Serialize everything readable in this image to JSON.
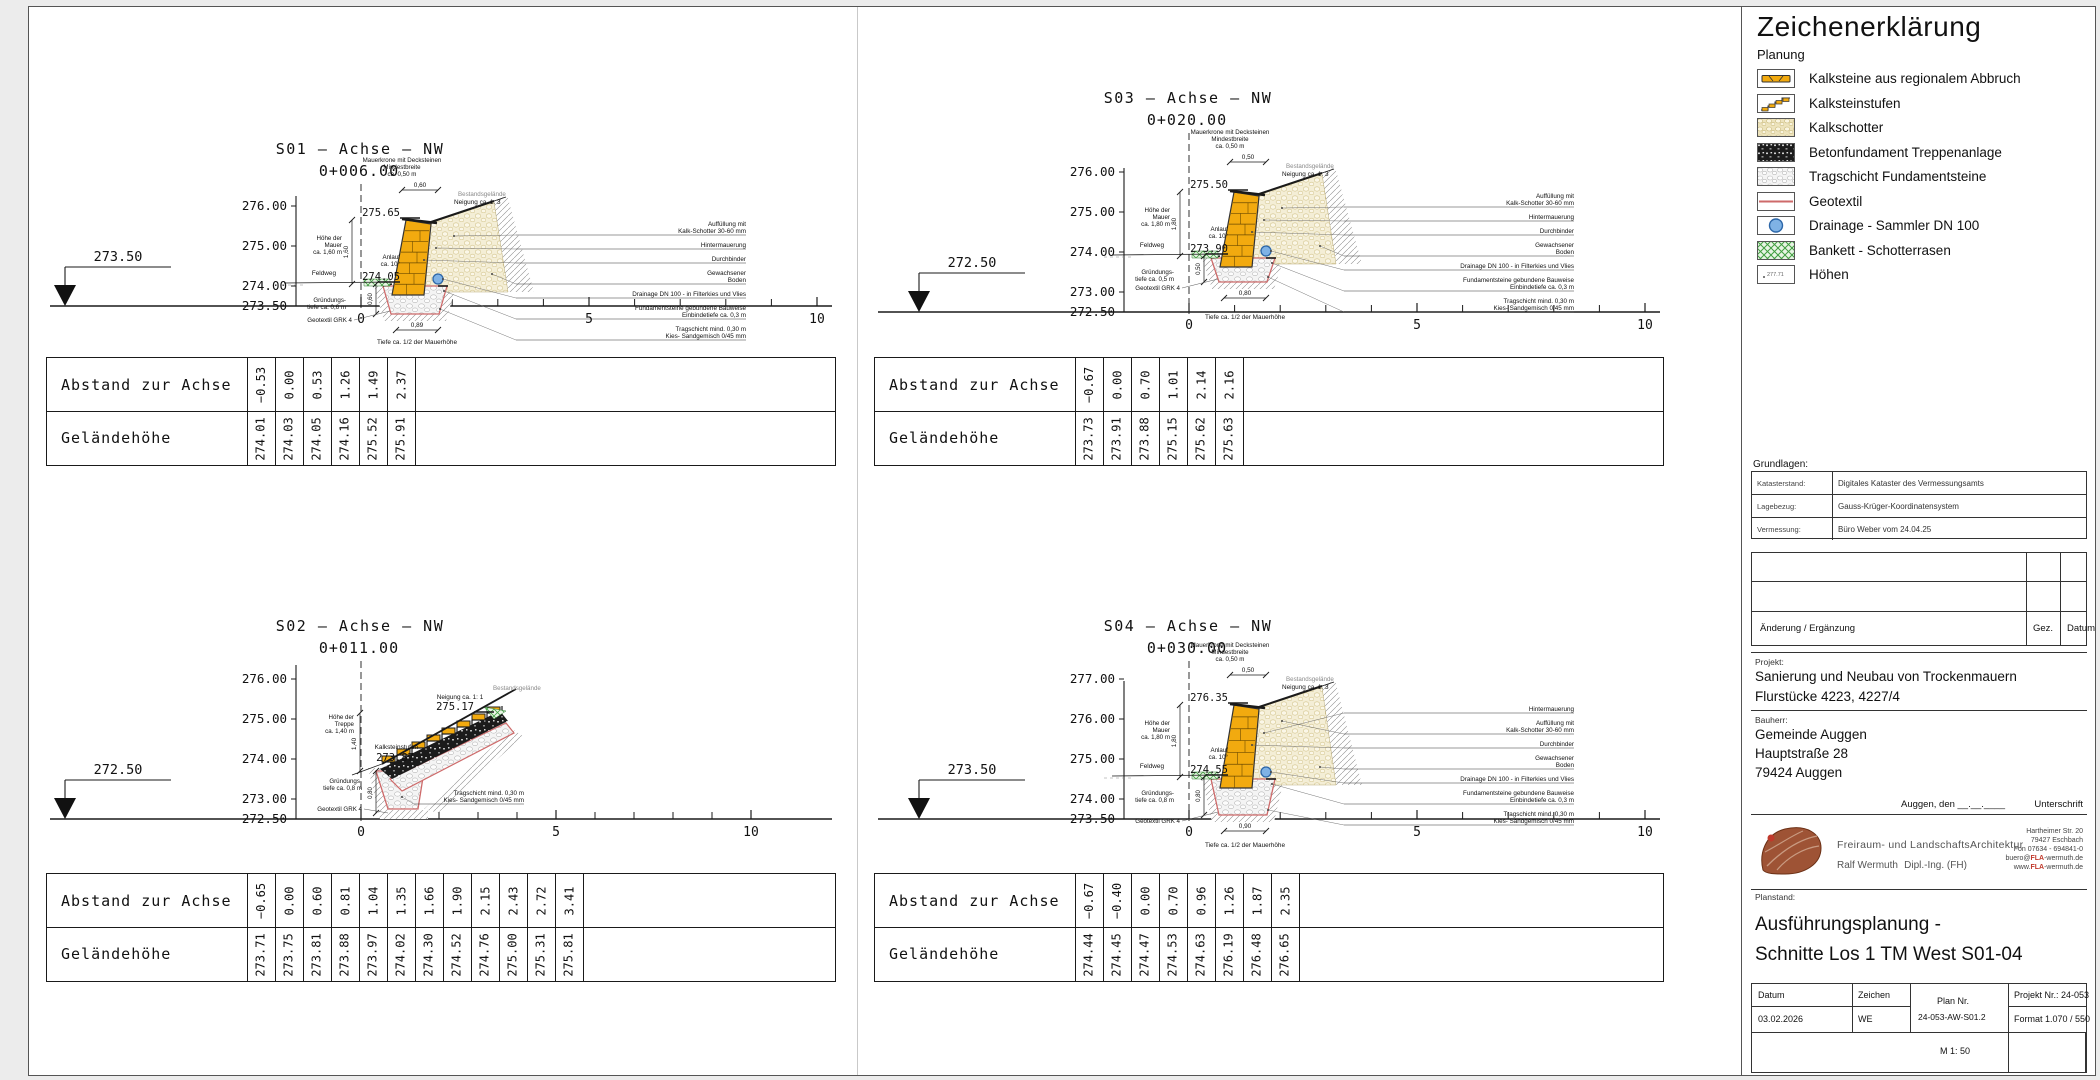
{
  "colors": {
    "stone": "#F2AA0F",
    "stone_edge": "#333333",
    "backfill_bg": "#F4EED6",
    "backfill_dot": "#D3C48C",
    "tragschicht_bg": "#F4F4F4",
    "tragschicht_dot": "#B8B8B8",
    "hatch": "#8F8F8F",
    "geotextil": "#CE6A6A",
    "drainage_fill": "#7FB2E5",
    "drainage_edge": "#2C66A8",
    "green": "#44A244",
    "beton": "#1B1B1B"
  },
  "table_labels": {
    "abstand": "Abstand zur Achse",
    "gelaende": "Geländehöhe"
  },
  "sections": [
    {
      "id": "S01",
      "title": "S01  –  Achse  –  NW",
      "station": "0+006.00",
      "type": "wall",
      "ref_height": "273.50",
      "datum_elev": 273.5,
      "y_ticks": [
        "276.00",
        "275.00",
        "274.00",
        "273.50"
      ],
      "x_ticks": [
        "0",
        "5",
        "10"
      ],
      "crest_label": "275.65",
      "crest_elev": 275.65,
      "base_label": "274.05",
      "base_elev": 274.05,
      "top_note": [
        "Mauerkrone mit Decksteinen",
        "Mindestbreite",
        "ca. 0,50 m"
      ],
      "slope_note": "Neigung ca. 1: 3",
      "terrain_label": "Bestandsgelände",
      "left_notes": {
        "hoehe": [
          "Höhe der",
          "Mauer",
          "ca. 1,60 m"
        ],
        "weg": "Feldweg",
        "anlauf": [
          "Anlauf",
          "ca. 10°"
        ],
        "gruendung": [
          "Gründungs-",
          "tiefe ca. 0,6 m"
        ],
        "geotextil": "Geotextil GRK 4"
      },
      "dims": {
        "top": "0,60",
        "height": "1,60",
        "depth": "0,60",
        "bottom": "0,89"
      },
      "right_notes": [
        [
          "Auffüllung mit",
          "Kalk-Schotter 30-60 mm"
        ],
        [
          "Hintermauerung"
        ],
        [
          "Durchbinder"
        ],
        [
          "Gewachsener",
          "Boden"
        ],
        [
          "Drainage DN 100 - in Filterkies und Vlies"
        ],
        [
          "Fundamentsteine gebundene Bauweise",
          "Einbindetiefe ca. 0,3 m"
        ],
        [
          "Tragschicht mind. 0,30 m",
          "Kies- Sandgemisch 0/45 mm"
        ]
      ],
      "bottom_note": "Tiefe ca. 1/2 der Mauerhöhe",
      "table": {
        "abstand": [
          "-0.53",
          "0.00",
          "0.53",
          "1.26",
          "1.49",
          "2.37"
        ],
        "gelaende": [
          "274.01",
          "274.03",
          "274.05",
          "274.16",
          "275.52",
          "275.91"
        ]
      }
    },
    {
      "id": "S02",
      "title": "S02  –  Achse  –  NW",
      "station": "0+011.00",
      "type": "stairs",
      "ref_height": "272.50",
      "datum_elev": 272.5,
      "y_ticks": [
        "276.00",
        "275.00",
        "274.00",
        "273.00",
        "272.50"
      ],
      "x_ticks": [
        "0",
        "5",
        "10"
      ],
      "crest_label": "275.17",
      "crest_elev": 275.17,
      "base_label": "273.87",
      "base_elev": 273.87,
      "slope_note": "Neigung ca. 1: 1",
      "terrain_label": "Bestandsgelände",
      "stufen_label": "Kalksteinstufen",
      "left_notes": {
        "hoehe": [
          "Höhe der",
          "Treppe",
          "ca. 1,40 m"
        ],
        "gruendung": [
          "Gründungs-",
          "tiefe ca. 0,8 m"
        ],
        "geotextil": "Geotextil GRK 4"
      },
      "dims": {
        "height": "1,40",
        "depth": "0,80"
      },
      "right_notes": [
        [
          "Tragschicht mind. 0,30 m",
          "Kies- Sandgemisch 0/45 mm"
        ]
      ],
      "table": {
        "abstand": [
          "-0.65",
          "0.00",
          "0.60",
          "0.81",
          "1.04",
          "1.35",
          "1.66",
          "1.90",
          "2.15",
          "2.43",
          "2.72",
          "3.41"
        ],
        "gelaende": [
          "273.71",
          "273.75",
          "273.81",
          "273.88",
          "273.97",
          "274.02",
          "274.30",
          "274.52",
          "274.76",
          "275.00",
          "275.31",
          "275.81"
        ]
      }
    },
    {
      "id": "S03",
      "title": "S03  –  Achse  –  NW",
      "station": "0+020.00",
      "type": "wall",
      "ref_height": "272.50",
      "datum_elev": 272.5,
      "y_ticks": [
        "276.00",
        "275.00",
        "274.00",
        "273.00",
        "272.50"
      ],
      "x_ticks": [
        "0",
        "5",
        "10"
      ],
      "crest_label": "275.50",
      "crest_elev": 275.5,
      "base_label": "273.90",
      "base_elev": 273.9,
      "top_note": [
        "Mauerkrone mit Decksteinen",
        "Mindestbreite",
        "ca. 0,50 m"
      ],
      "slope_note": "Neigung ca. 1: 3",
      "terrain_label": "Bestandsgelände",
      "left_notes": {
        "hoehe": [
          "Höhe der",
          "Mauer",
          "ca. 1,80 m"
        ],
        "weg": "Feldweg",
        "anlauf": [
          "Anlauf",
          "ca. 10°"
        ],
        "gruendung": [
          "Gründungs-",
          "tiefe ca. 0,5 m"
        ],
        "geotextil": "Geotextil GRK 4"
      },
      "dims": {
        "top": "0,50",
        "height": "1,80",
        "depth": "0,50",
        "bottom": "0,80"
      },
      "right_notes": [
        [
          "Auffüllung mit",
          "Kalk-Schotter 30-60 mm"
        ],
        [
          "Hintermauerung"
        ],
        [
          "Durchbinder"
        ],
        [
          "Gewachsener",
          "Boden"
        ],
        [
          "Drainage DN 100 - in Filterkies und Vlies"
        ],
        [
          "Fundamentsteine gebundene Bauweise",
          "Einbindetiefe ca. 0,3 m"
        ],
        [
          "Tragschicht mind. 0,30 m",
          "Kies- Sandgemisch 0/45 mm"
        ]
      ],
      "bottom_note": "Tiefe ca. 1/2 der Mauerhöhe",
      "table": {
        "abstand": [
          "-0.67",
          "0.00",
          "0.70",
          "1.01",
          "2.14",
          "2.16"
        ],
        "gelaende": [
          "273.73",
          "273.91",
          "273.88",
          "275.15",
          "275.62",
          "275.63"
        ]
      }
    },
    {
      "id": "S04",
      "title": "S04  –  Achse  –  NW",
      "station": "0+030.00",
      "type": "wall",
      "ref_height": "273.50",
      "datum_elev": 273.5,
      "y_ticks": [
        "277.00",
        "276.00",
        "275.00",
        "274.00",
        "273.50"
      ],
      "x_ticks": [
        "0",
        "5",
        "10"
      ],
      "crest_label": "276.35",
      "crest_elev": 276.35,
      "base_label": "274.55",
      "base_elev": 274.55,
      "top_note": [
        "Mauerkrone mit Decksteinen",
        "Mindestbreite",
        "ca. 0,50 m"
      ],
      "slope_note": "Neigung ca. 1: 3",
      "terrain_label": "Bestandsgelände",
      "left_notes": {
        "hoehe": [
          "Höhe der",
          "Mauer",
          "ca. 1,80 m"
        ],
        "weg": "Feldweg",
        "anlauf": [
          "Anlauf",
          "ca. 10°"
        ],
        "gruendung": [
          "Gründungs-",
          "tiefe ca. 0,8 m"
        ],
        "geotextil": "Geotextil GRK 4"
      },
      "dims": {
        "top": "0,50",
        "height": "1,80",
        "depth": "0,80",
        "bottom": "0,90"
      },
      "right_notes": [
        [
          "Hintermauerung"
        ],
        [
          "Auffüllung mit",
          "Kalk-Schotter 30-60 mm"
        ],
        [
          "Durchbinder"
        ],
        [
          "Gewachsener",
          "Boden"
        ],
        [
          "Drainage DN 100 - in Filterkies und Vlies"
        ],
        [
          "Fundamentsteine gebundene Bauweise",
          "Einbindetiefe ca. 0,3 m"
        ],
        [
          "Tragschicht mind. 0,30 m",
          "Kies- Sandgemisch 0/45 mm"
        ]
      ],
      "bottom_note": "Tiefe ca. 1/2 der Mauerhöhe",
      "table": {
        "abstand": [
          "-0.67",
          "-0.40",
          "0.00",
          "0.70",
          "0.96",
          "1.26",
          "1.87",
          "2.35"
        ],
        "gelaende": [
          "274.44",
          "274.45",
          "274.47",
          "274.53",
          "274.63",
          "276.19",
          "276.48",
          "276.65"
        ]
      }
    }
  ],
  "sidebar": {
    "legend": {
      "title": "Zeichenerklärung",
      "subtitle": "Planung",
      "items": [
        {
          "label": "Kalksteine aus regionalem Abbruch",
          "type": "kalksteine"
        },
        {
          "label": "Kalksteinstufen",
          "type": "stufen"
        },
        {
          "label": "Kalkschotter",
          "type": "schotter"
        },
        {
          "label": "Betonfundament  Treppenanlage",
          "type": "beton"
        },
        {
          "label": "Tragschicht Fundamentsteine",
          "type": "tragschicht"
        },
        {
          "label": "Geotextil",
          "type": "geotextil"
        },
        {
          "label": "Drainage - Sammler DN 100",
          "type": "drainage"
        },
        {
          "label": "Bankett - Schotterrasen",
          "type": "bankett"
        },
        {
          "label": "Höhen",
          "type": "hoehen",
          "swatch_text": "277.71"
        }
      ]
    },
    "grundlagen": {
      "label": "Grundlagen:",
      "rows": [
        {
          "k": "Katasterstand:",
          "v": "Digitales Kataster des Vermessungsamts"
        },
        {
          "k": "Lagebezug:",
          "v": "Gauss-Krüger-Koordinatensystem"
        },
        {
          "k": "Vermessung:",
          "v": "Büro Weber vom 24.04.25"
        }
      ]
    },
    "aenderung": {
      "label": "Änderung / Ergänzung",
      "gez": "Gez.",
      "datum": "Datum"
    },
    "projekt": {
      "label": "Projekt:",
      "lines": [
        "Sanierung und Neubau von Trockenmauern",
        "Flurstücke 4223, 4227/4"
      ]
    },
    "bauherr": {
      "label": "Bauherr:",
      "lines": [
        "Gemeinde Auggen",
        "Hauptstraße 28",
        "79424 Auggen"
      ],
      "ort_datum": "Auggen, den __.__.____",
      "unterschrift": "Unterschrift"
    },
    "firma": {
      "zeile1": "Freiraum- und LandschaftsArchitektur",
      "name": "Ralf Wermuth",
      "grad": "Dipl.-Ing. (FH)",
      "adresse": [
        "Hartheimer Str. 20",
        "79427 Eschbach",
        "Fon 07634 - 694841-0",
        "buero@FLA-wermuth.de",
        "www.FLA-wermuth.de"
      ]
    },
    "planstand": {
      "label": "Planstand:",
      "lines": [
        "Ausführungsplanung -",
        "Schnitte Los 1 TM West S01-04"
      ]
    },
    "plantafel": {
      "datum_label": "Datum",
      "datum": "03.02.2026",
      "zeichen_label": "Zeichen",
      "zeichen": "WE",
      "plannr_label": "Plan Nr.",
      "plannr": "24-053-AW-S01.2",
      "projektnr": "Projekt Nr.: 24-053",
      "format": "Format 1.070 / 550",
      "massstab": "M 1: 50"
    }
  }
}
